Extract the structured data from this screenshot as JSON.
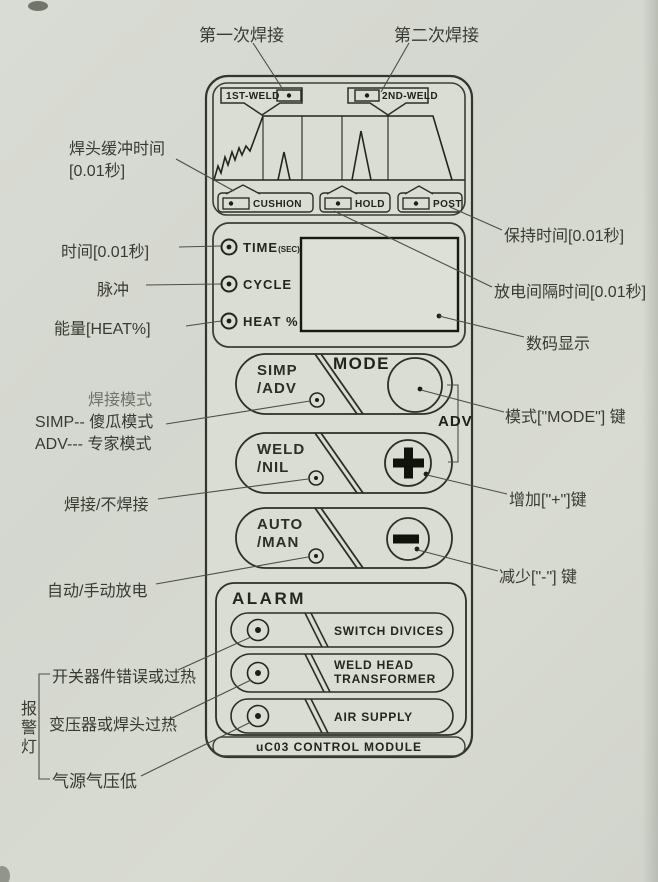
{
  "colors": {
    "page_bg": "#d6d9d1",
    "panel_fill": "#daddd4",
    "outline": "#31362c",
    "leader": "#4b4e45",
    "text": "#383b31"
  },
  "icons": {
    "led": "led-indicator",
    "mode_button": "circle-button",
    "plus_button": "plus",
    "minus_button": "minus"
  },
  "callouts": {
    "first_weld": "第一次焊接",
    "second_weld": "第二次焊接",
    "cushion_time_line1": "焊头缓冲时间",
    "cushion_time_line2": "[0.01秒]",
    "time_unit": "时间[0.01秒]",
    "pulse": "脉冲",
    "energy": "能量[HEAT%]",
    "weld_mode": "焊接模式",
    "simp_mode": "SIMP-- 傻瓜模式",
    "adv_mode": "ADV--- 专家模式",
    "weld_or_not": "焊接/不焊接",
    "auto_manual_discharge": "自动/手动放电",
    "switch_device_error": "开关器件错误或过热",
    "transformer_overheat": "变压器或焊头过热",
    "air_pressure_low": "气源气压低",
    "alarm_lamps": "报警灯",
    "hold_time": "保持时间[0.01秒]",
    "discharge_interval": "放电间隔时间[0.01秒]",
    "digital_display": "数码显示",
    "mode_key": "模式[\"MODE\"] 键",
    "adv_bracket_label": "ADV",
    "increase_key": "增加[\"+\"]键",
    "decrease_key": "减少[\"-\"] 键"
  },
  "panel": {
    "weld1_tag": "1ST-WELD",
    "weld2_tag": "2ND-WELD",
    "cushion_tag": "CUSHION",
    "hold_tag": "HOLD",
    "post_tag": "POST",
    "time_led": "TIME",
    "time_led_sub": "(SEC)",
    "cycle_led": "CYCLE",
    "heat_led": "HEAT %",
    "mode_label": "MODE",
    "simp_btn_line1": "SIMP",
    "simp_btn_line2": "/ADV",
    "weld_btn_line1": "WELD",
    "weld_btn_line2": "/NIL",
    "auto_btn_line1": "AUTO",
    "auto_btn_line2": "/MAN",
    "alarm_title": "ALARM",
    "alarm_switch": "SWITCH DIVICES",
    "alarm_weldhead_line1": "WELD HEAD",
    "alarm_weldhead_line2": "TRANSFORMER",
    "alarm_air": "AIR SUPPLY",
    "footer": "uC03 CONTROL MODULE"
  }
}
